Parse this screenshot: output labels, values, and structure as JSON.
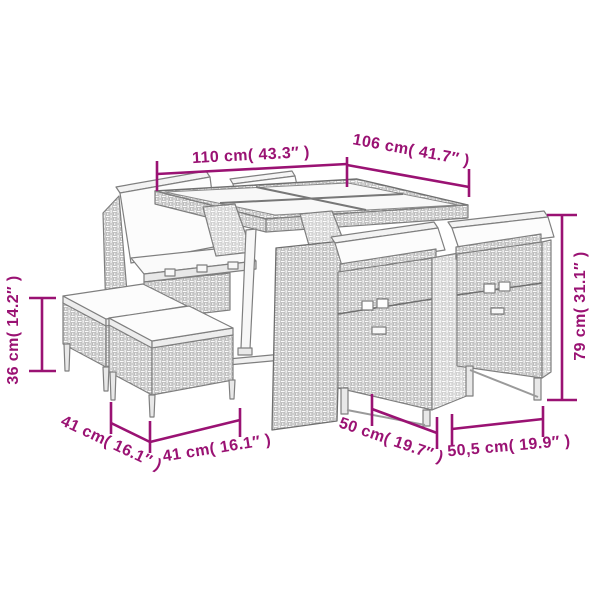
{
  "diagram": {
    "type": "product-dimension-diagram",
    "subject": "poly-rattan garden dining set (table, chairs, stools) line drawing",
    "colors": {
      "dimension_accent": "#9A1273",
      "furniture_outline": "#7f7f7f",
      "background": "#ffffff"
    },
    "dimensions": {
      "table_length": {
        "label": "110 cm( 43.3″ )"
      },
      "table_width": {
        "label": "106 cm( 41.7″ )"
      },
      "stool_height": {
        "label": "36 cm( 14.2″ )"
      },
      "stool_depth": {
        "label": "41 cm( 16.1″ )"
      },
      "stool_width": {
        "label": "41 cm( 16.1″ )"
      },
      "chair_depth": {
        "label": "50 cm( 19.7″ )"
      },
      "chair_width": {
        "label": "50,5 cm( 19.9″ )"
      },
      "chair_height": {
        "label": "79 cm( 31.1″ )"
      }
    }
  }
}
